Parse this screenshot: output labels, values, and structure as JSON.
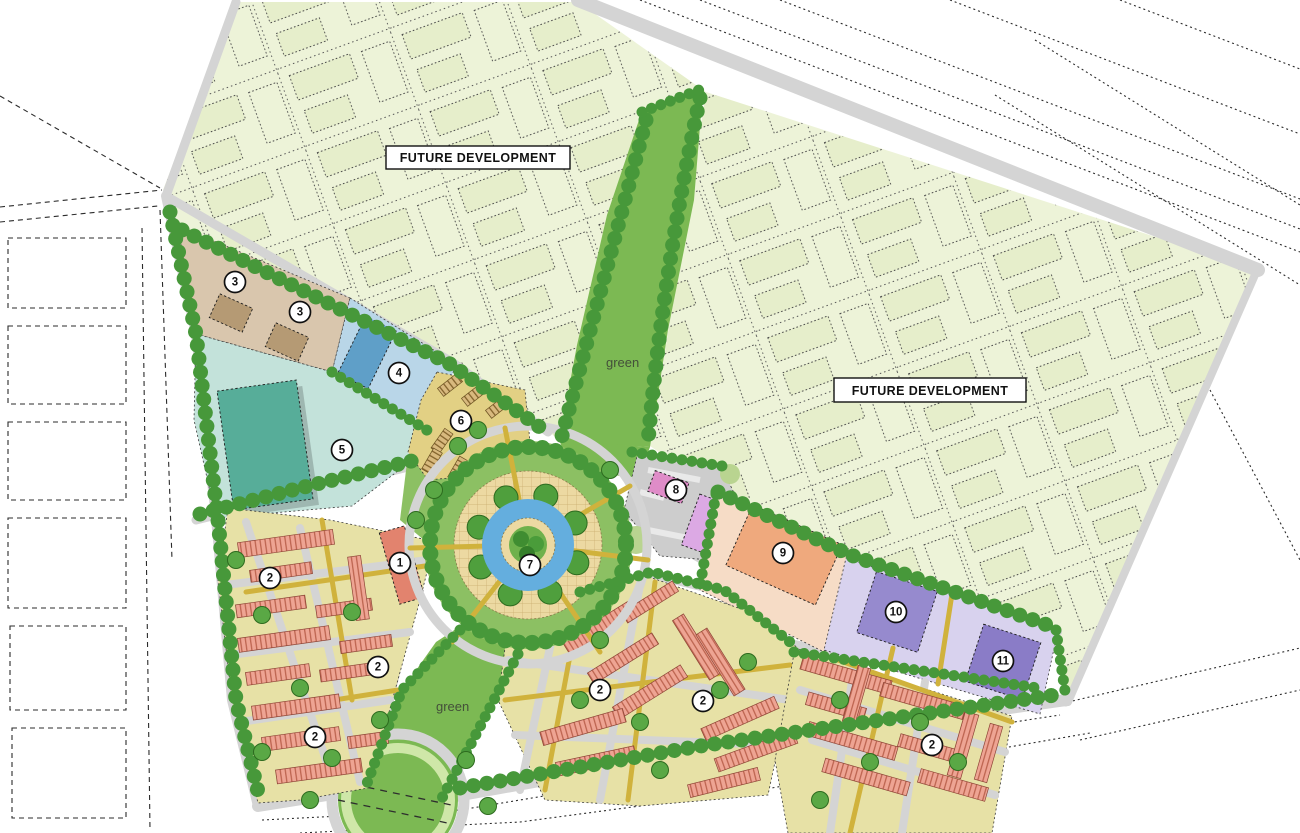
{
  "labels": {
    "future_development_west": "FUTURE DEVELOPMENT",
    "future_development_east": "FUTURE DEVELOPMENT",
    "green_corridor": "green",
    "green_south": "green"
  },
  "zone_markers": [
    {
      "number": "1",
      "x": 400,
      "y": 563
    },
    {
      "number": "2",
      "x": 270,
      "y": 578
    },
    {
      "number": "2",
      "x": 378,
      "y": 667
    },
    {
      "number": "2",
      "x": 315,
      "y": 737
    },
    {
      "number": "2",
      "x": 600,
      "y": 690
    },
    {
      "number": "2",
      "x": 703,
      "y": 701
    },
    {
      "number": "2",
      "x": 932,
      "y": 745
    },
    {
      "number": "3",
      "x": 235,
      "y": 282
    },
    {
      "number": "3",
      "x": 300,
      "y": 312
    },
    {
      "number": "4",
      "x": 399,
      "y": 373
    },
    {
      "number": "5",
      "x": 342,
      "y": 450
    },
    {
      "number": "6",
      "x": 461,
      "y": 421
    },
    {
      "number": "7",
      "x": 530,
      "y": 565
    },
    {
      "number": "8",
      "x": 676,
      "y": 490
    },
    {
      "number": "9",
      "x": 783,
      "y": 553
    },
    {
      "number": "10",
      "x": 896,
      "y": 612
    },
    {
      "number": "11",
      "x": 1003,
      "y": 661
    }
  ],
  "colors": {
    "background": "#ffffff",
    "future_development_fill": "#edf3d8",
    "park_green": "#7cb953",
    "grass_light": "#8cc063",
    "tree_green": "#47983a",
    "road_gray": "#d4d4d4",
    "path_yellow": "#d0b23c",
    "water_blue": "#64aede",
    "plaza_tan": "#ecd9a2",
    "courtyard_khaki": "#e7e1a6",
    "rowhouse_salmon": "#eea493",
    "zone3_tan": "#d9c6ad",
    "zone4_blue": "#b9d6e8",
    "zone5_teal": "#c3e2da",
    "zone6_yellow": "#e2d084",
    "zone8_pink": "#df8cc8",
    "zone9_orange": "#efa97d",
    "zone10_purple": "#968ace",
    "zone11_purple": "#8a7cc7",
    "marker_fill": "#ffffff",
    "marker_stroke": "#101010"
  }
}
